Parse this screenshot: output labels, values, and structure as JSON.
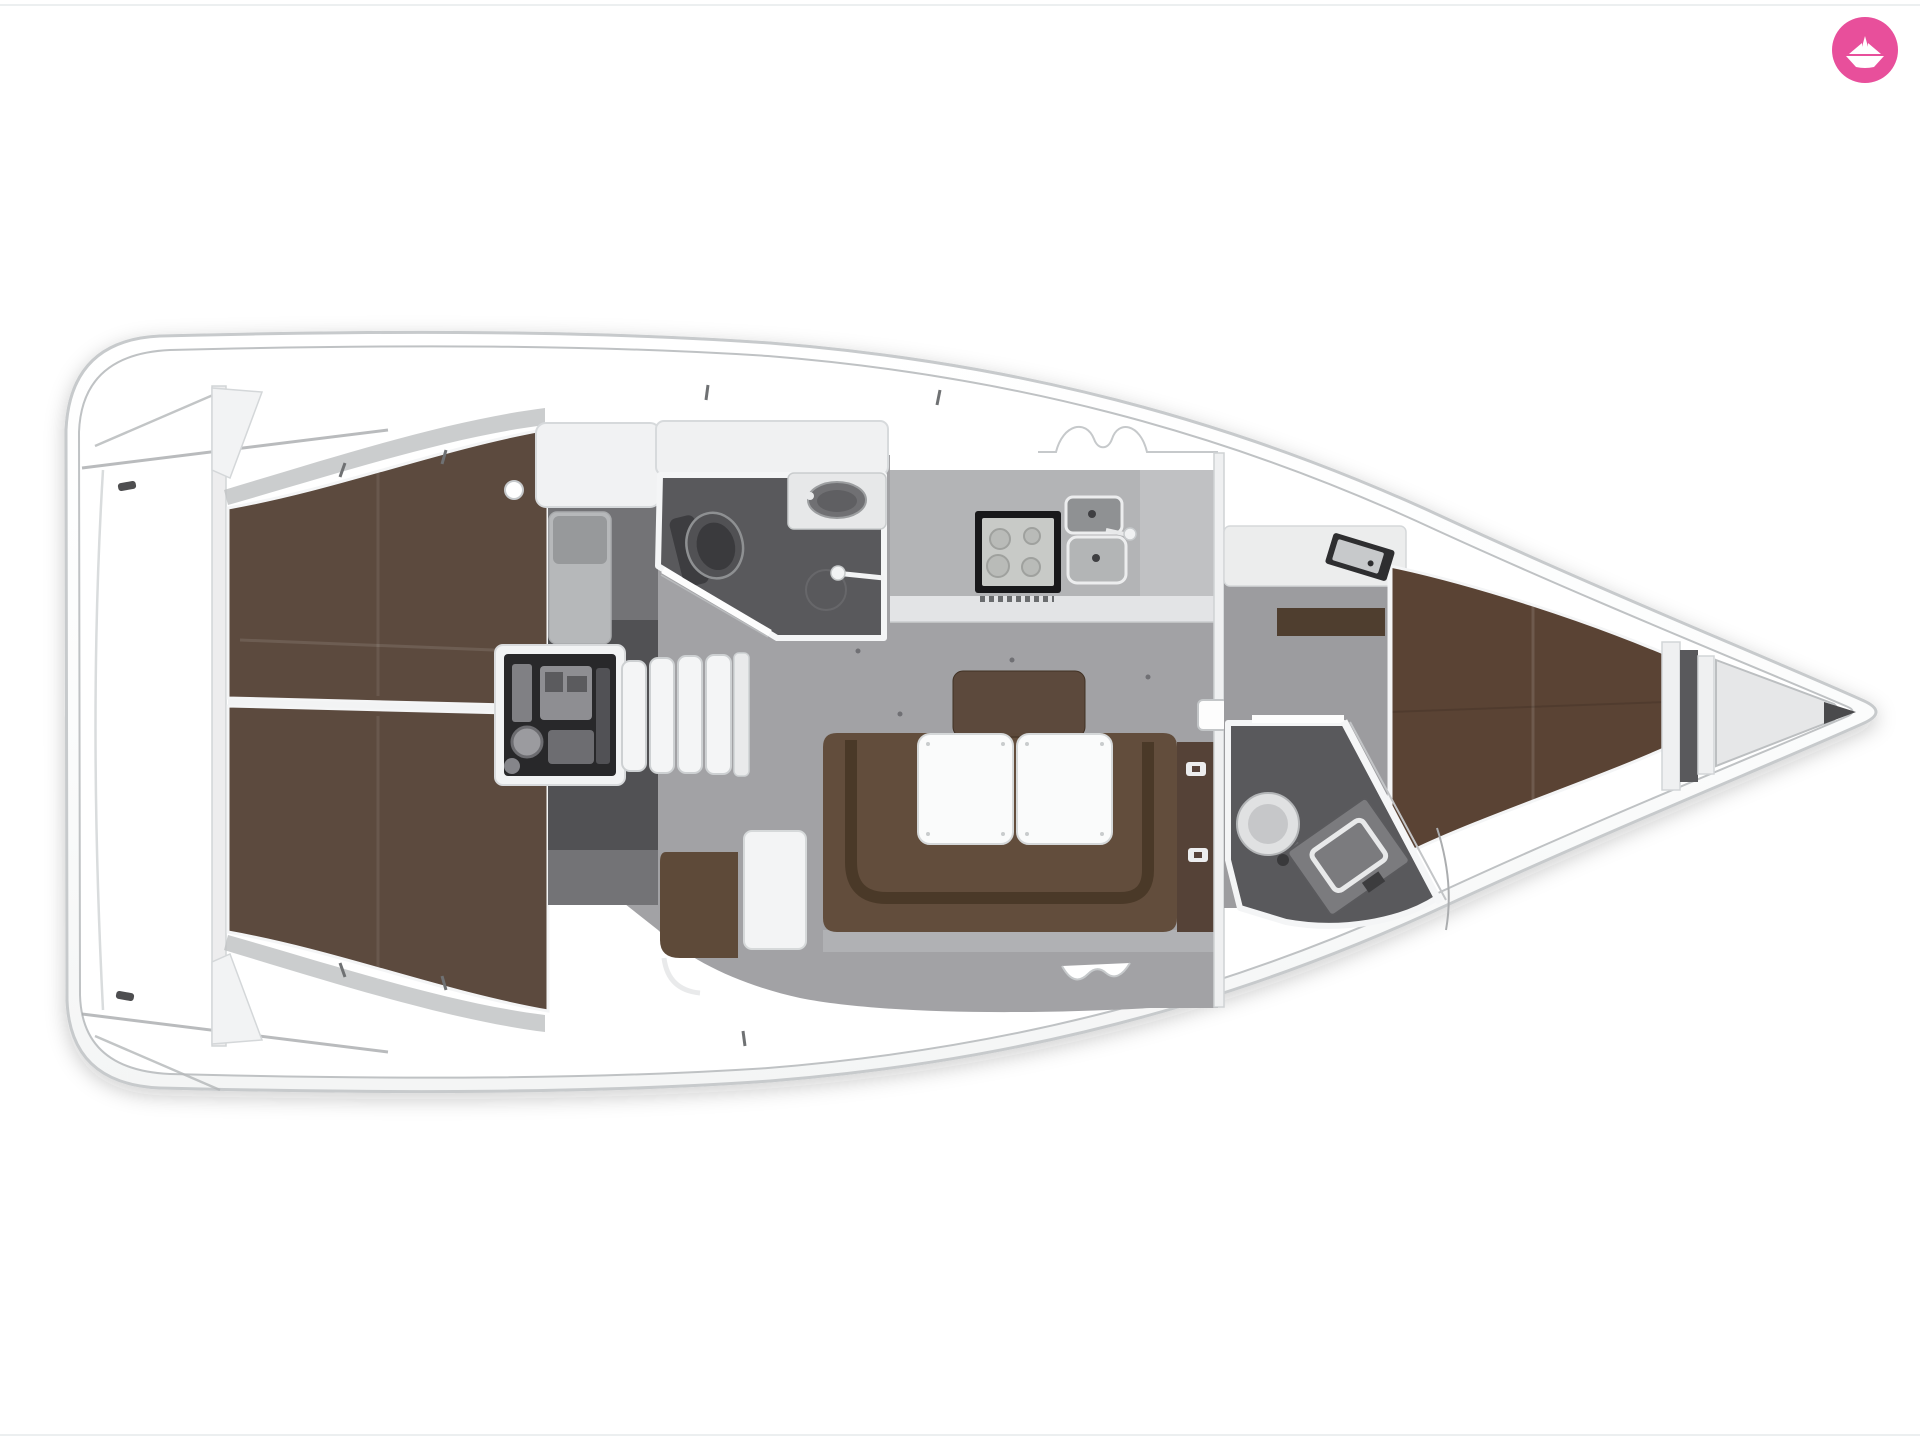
{
  "image": {
    "kind": "yacht-interior-floor-plan",
    "description": "Top-down 3D rendered floor plan of a sailing yacht, bow pointing right",
    "background": "#ffffff"
  },
  "logo": {
    "name": "paper-boat-badge",
    "color": "#e84f9b",
    "glyph": "white origami paper boat",
    "label": "boat charter logo"
  },
  "palette": {
    "hull_white": "#fcfcfd",
    "hull_outline": "#c7cacc",
    "deck_line": "#bfc2c4",
    "salon_floor": "#a2a2a5",
    "passage_floor": "#9c9c9f",
    "head_floor": "#59595c",
    "companionway_floor": "#737376",
    "berth_brown": "#5c4a3e",
    "settee_brown": "#624d3c",
    "vberth_brown": "#5a4334",
    "engine_dark": "#28282a",
    "stove_black": "#18181a",
    "counter_gray": "#b3b4b6",
    "furniture_white": "#f2f3f4",
    "accent_pink": "#e84f9b"
  },
  "rooms": {
    "stern_deck": {
      "label": "stern deck and swim platform"
    },
    "aft_cabin_port": {
      "label": "aft cabin port double berth"
    },
    "aft_cabin_starboard": {
      "label": "aft cabin starboard double berth"
    },
    "engine": {
      "label": "engine compartment"
    },
    "companionway": {
      "label": "companionway stairs"
    },
    "aft_head": {
      "label": "aft bathroom with toilet, sink and shower"
    },
    "salon": {
      "label": "salon with U-shaped settee and folding table"
    },
    "galley": {
      "label": "galley with stove and twin sinks"
    },
    "nav": {
      "label": "navigation seat and table"
    },
    "fwd_cabin": {
      "label": "forward cabin V-berth"
    },
    "fwd_head": {
      "label": "forward bathroom with toilet and vanity"
    },
    "bow_locker": {
      "label": "anchor locker"
    }
  }
}
